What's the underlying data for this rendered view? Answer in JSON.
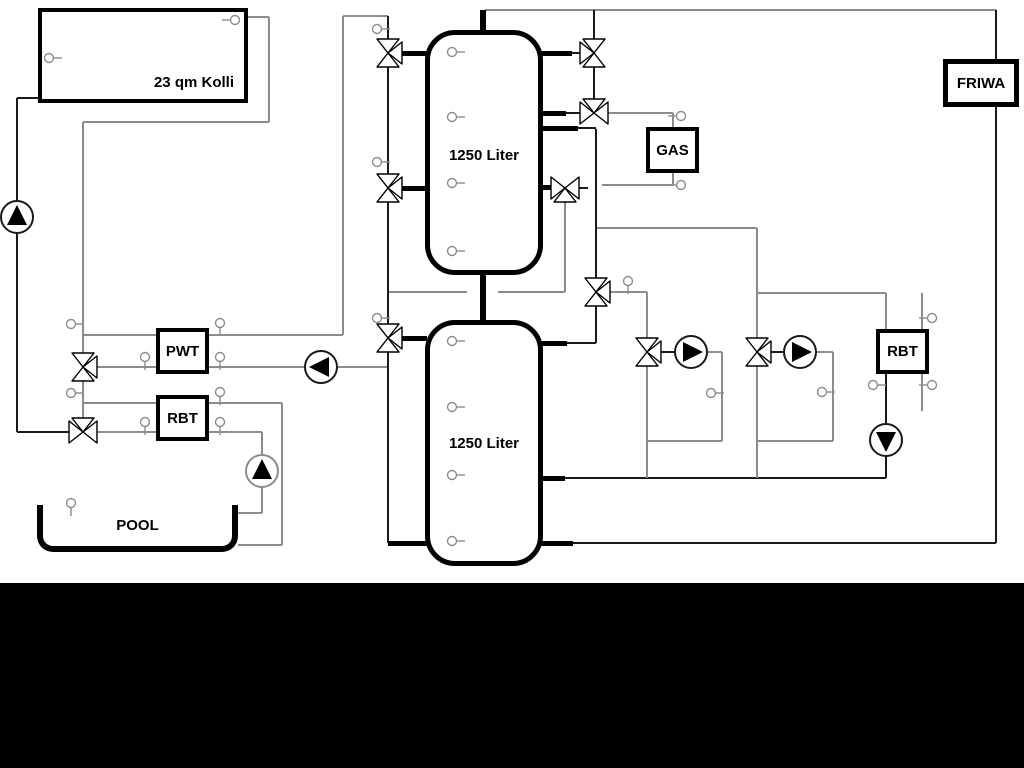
{
  "labels": {
    "collector": "23 qm Kolli",
    "tank_top": "1250 Liter",
    "tank_bottom": "1250 Liter",
    "heat_exchanger": "PWT",
    "rbt_left": "RBT",
    "boiler": "GAS",
    "fresh_water": "FRIWA",
    "rbt_right": "RBT",
    "pool": "POOL"
  },
  "colors": {
    "background": "#ffffff",
    "pipe_gray": "#8c8c8c",
    "pipe_black": "#1a1a1a",
    "footer_bar": "#000000"
  }
}
